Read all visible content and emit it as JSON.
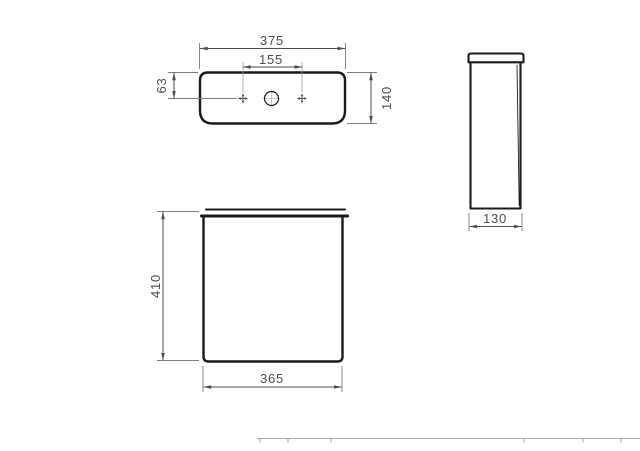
{
  "drawing": {
    "top_view": {
      "dim_width": "375",
      "dim_hole_spacing": "155",
      "dim_hole_offset": "63",
      "dim_depth": "140"
    },
    "front_view": {
      "dim_height": "410",
      "dim_width": "365"
    },
    "side_view": {
      "dim_depth": "130"
    },
    "colors": {
      "outline": "#1a1a1a",
      "dimension_line": "#4d4d4d",
      "label_text": "#4d4d4d",
      "table_border": "#a8a8a8",
      "background": "#ffffff"
    }
  }
}
